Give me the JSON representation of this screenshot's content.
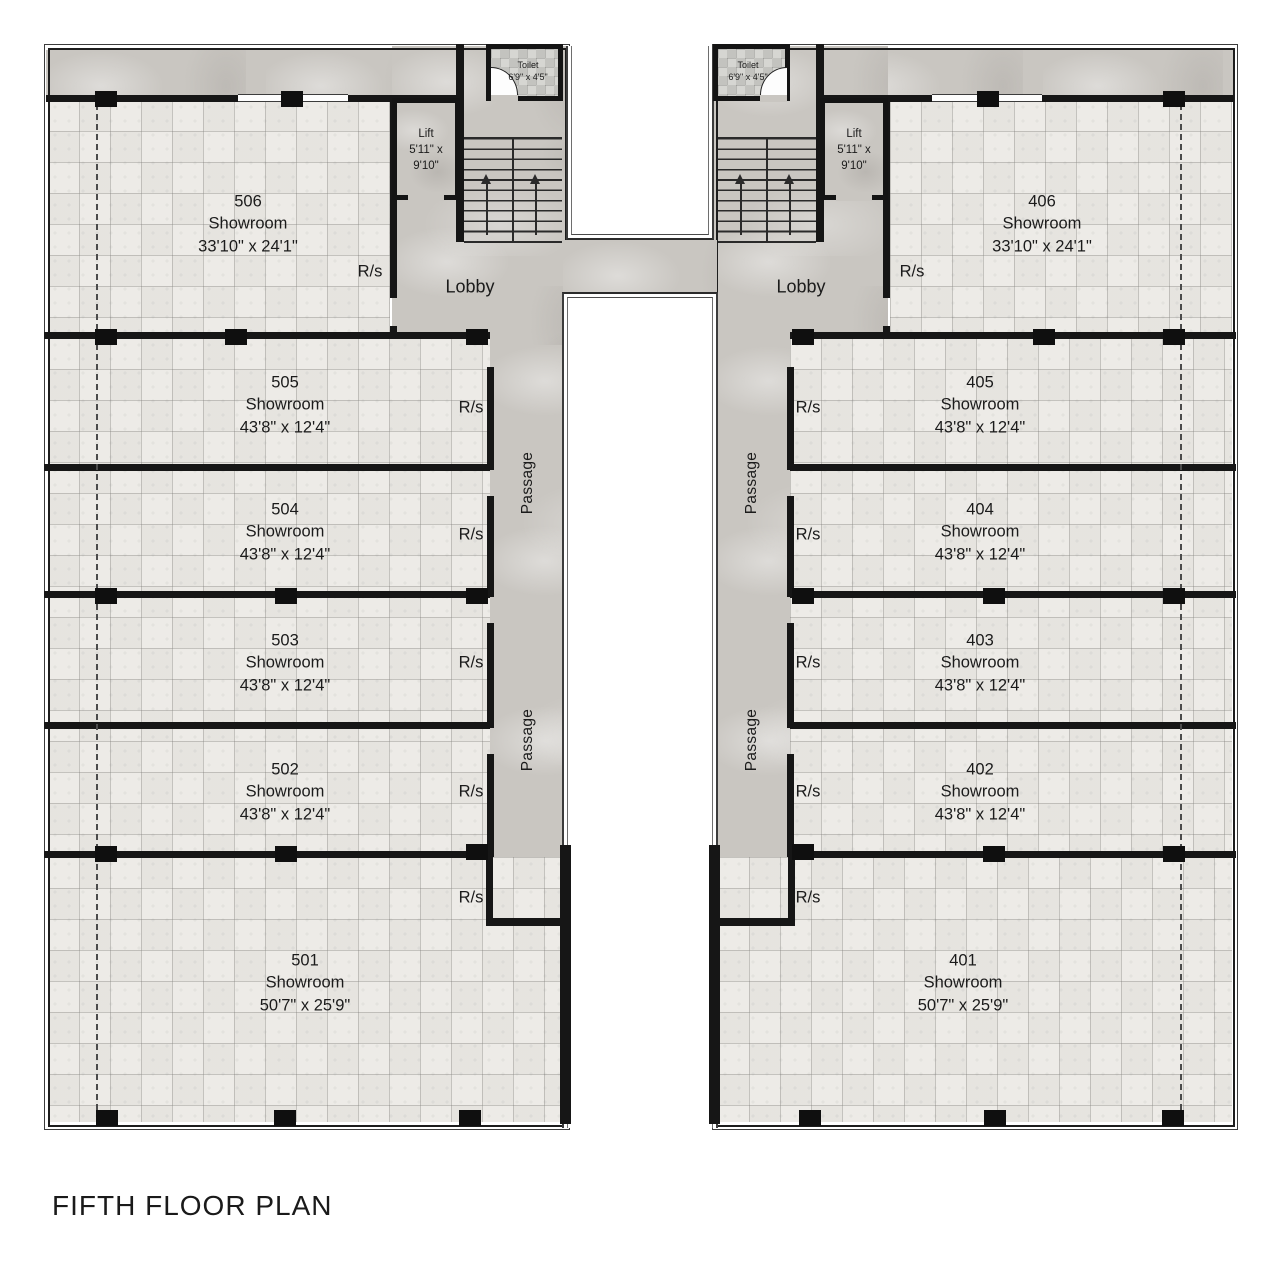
{
  "plan_title": "FIFTH FLOOR PLAN",
  "labels": {
    "showroom": "Showroom",
    "lobby": "Lobby",
    "passage": "Passage",
    "rs": "R/s",
    "lift": "Lift",
    "lift_size": "5'11\" x 9'10\"",
    "toilet": "Toilet",
    "toilet_size": "6'9\" x 4'5\""
  },
  "left_wing": {
    "showrooms": [
      {
        "number": "506",
        "size": "33'10\" x 24'1\""
      },
      {
        "number": "505",
        "size": "43'8\" x 12'4\""
      },
      {
        "number": "504",
        "size": "43'8\" x 12'4\""
      },
      {
        "number": "503",
        "size": "43'8\" x 12'4\""
      },
      {
        "number": "502",
        "size": "43'8\" x 12'4\""
      },
      {
        "number": "501",
        "size": "50'7\" x 25'9\""
      }
    ]
  },
  "right_wing": {
    "showrooms": [
      {
        "number": "406",
        "size": "33'10\" x 24'1\""
      },
      {
        "number": "405",
        "size": "43'8\" x 12'4\""
      },
      {
        "number": "404",
        "size": "43'8\" x 12'4\""
      },
      {
        "number": "403",
        "size": "43'8\" x 12'4\""
      },
      {
        "number": "402",
        "size": "43'8\" x 12'4\""
      },
      {
        "number": "401",
        "size": "50'7\" x 25'9\""
      }
    ]
  },
  "colors": {
    "wall": "#161616",
    "marble": "#c9c6c1",
    "tile_floor": "#edebe7",
    "text": "#1b1b1b"
  }
}
